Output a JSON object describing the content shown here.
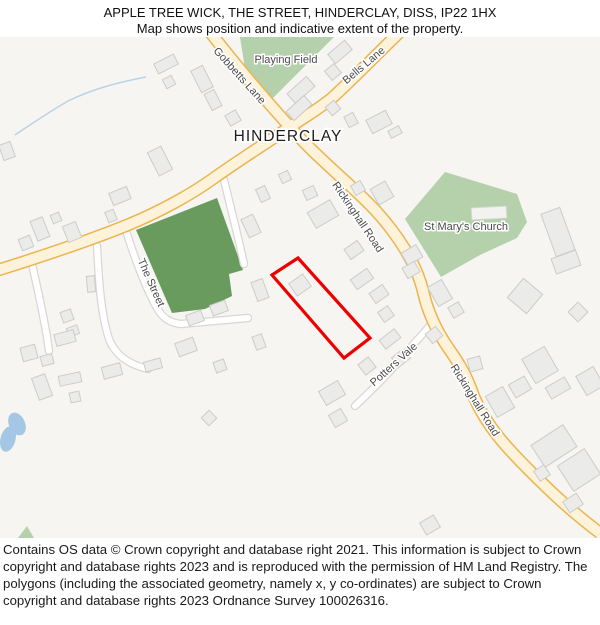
{
  "header": {
    "line1": "APPLE TREE WICK, THE STREET, HINDERCLAY, DISS, IP22 1HX",
    "line2": "Map shows position and indicative extent of the property."
  },
  "map": {
    "place_label": "HINDERCLAY",
    "labels": {
      "playing_field": "Playing Field",
      "gobbetts_lane": "Gobbetts Lane",
      "bells_lane": "Bells Lane",
      "rickinghall_road_upper": "Rickinghall Road",
      "rickinghall_road_lower": "Rickinghall Road",
      "st_marys_church": "St Mary's Church",
      "the_street": "The Street",
      "potters_vale": "Potters Vale"
    },
    "colors": {
      "major_road_fill": "#fdf3da",
      "major_road_casing": "#ecb44e",
      "minor_road_fill": "#ffffff",
      "minor_road_casing": "#d8d7d3",
      "green_area": "#b5d1ac",
      "dark_green_area": "#699b5e",
      "building_fill": "#ebebe9",
      "building_stroke": "#cccccb",
      "water": "#a4c7e6",
      "property_outline": "#ee0000",
      "map_background": "#f6f5f2"
    }
  },
  "footer": {
    "text": "Contains OS data © Crown copyright and database right 2021. This information is subject to Crown copyright and database rights 2023 and is reproduced with the permission of HM Land Registry. The polygons (including the associated geometry, namely x, y co-ordinates) are subject to Crown copyright and database rights 2023 Ordnance Survey 100026316."
  }
}
